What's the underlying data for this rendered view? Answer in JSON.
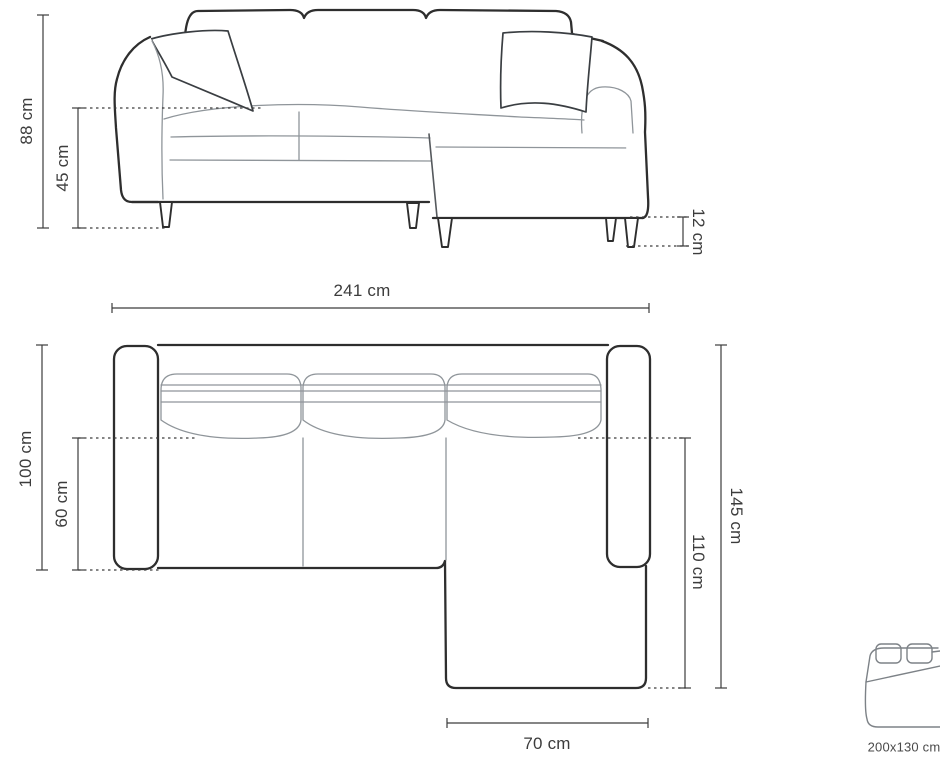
{
  "front_view": {
    "labels": {
      "total_height": "88 cm",
      "seat_height": "45 cm",
      "leg_height": "12 cm",
      "total_width": "241 cm"
    }
  },
  "top_view": {
    "labels": {
      "total_depth": "100 cm",
      "seat_depth": "60 cm",
      "total_length_right": "145 cm",
      "chaise_length": "110 cm",
      "chaise_width": "70 cm"
    }
  },
  "sleeping_area": {
    "label": "200x130 cm"
  }
}
